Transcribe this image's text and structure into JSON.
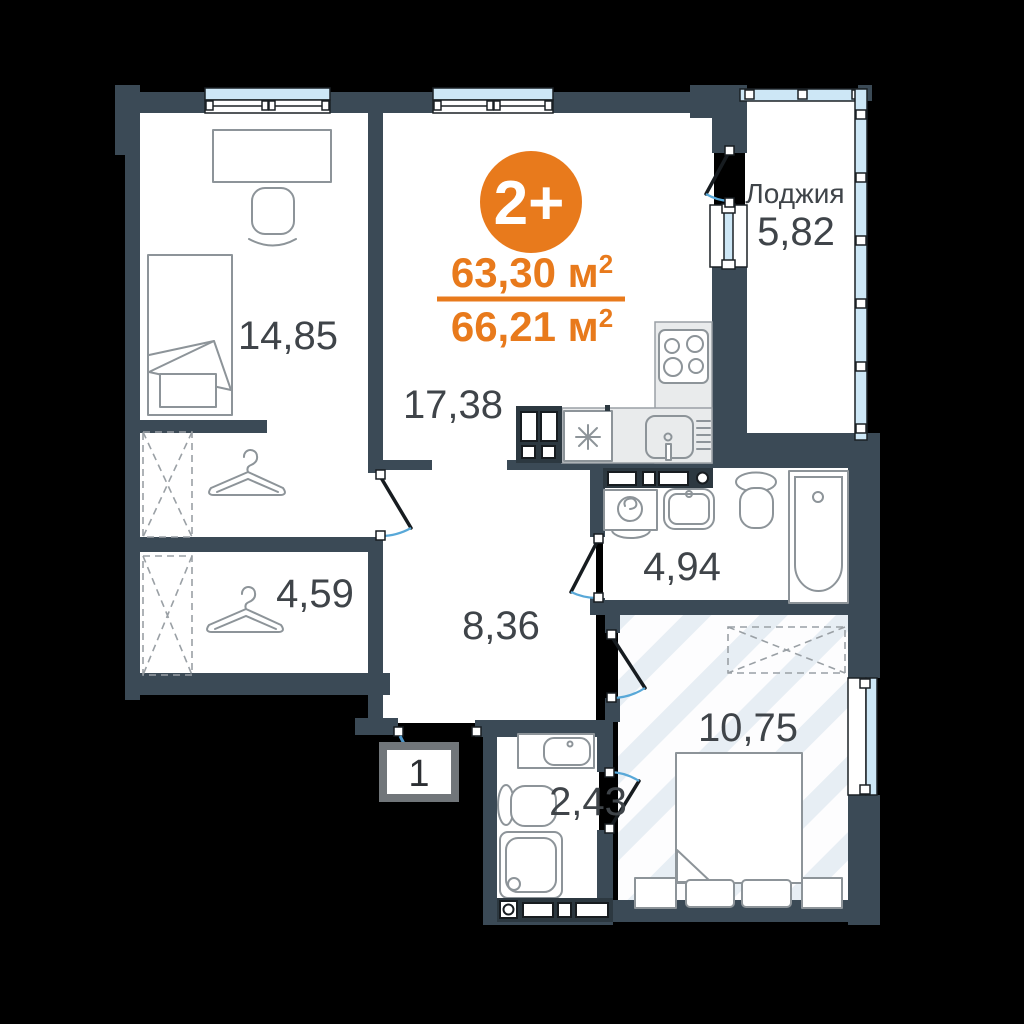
{
  "plan": {
    "type_badge": "2+",
    "area_living": "63,30 м",
    "area_total": "66,21 м",
    "sup": "2",
    "entrance_number": "1",
    "rooms": {
      "bedroom": {
        "area": "14,85"
      },
      "living_kitchen": {
        "area": "17,38"
      },
      "loggia": {
        "name": "Лоджия",
        "area": "5,82"
      },
      "wardrobe_hall": {
        "area": "4,59"
      },
      "hallway": {
        "area": "8,36"
      },
      "bathroom": {
        "area": "4,94"
      },
      "bedroom2": {
        "area": "10,75"
      },
      "shower_room": {
        "area": "2,43"
      }
    },
    "colors": {
      "wall": "#3b4a56",
      "accent_orange": "#e87a1c",
      "window_glass": "#cde7f6",
      "door_swing": "#58a8d8",
      "hatch_stripe": "#e7eef4",
      "label_text": "#3f4449"
    }
  }
}
